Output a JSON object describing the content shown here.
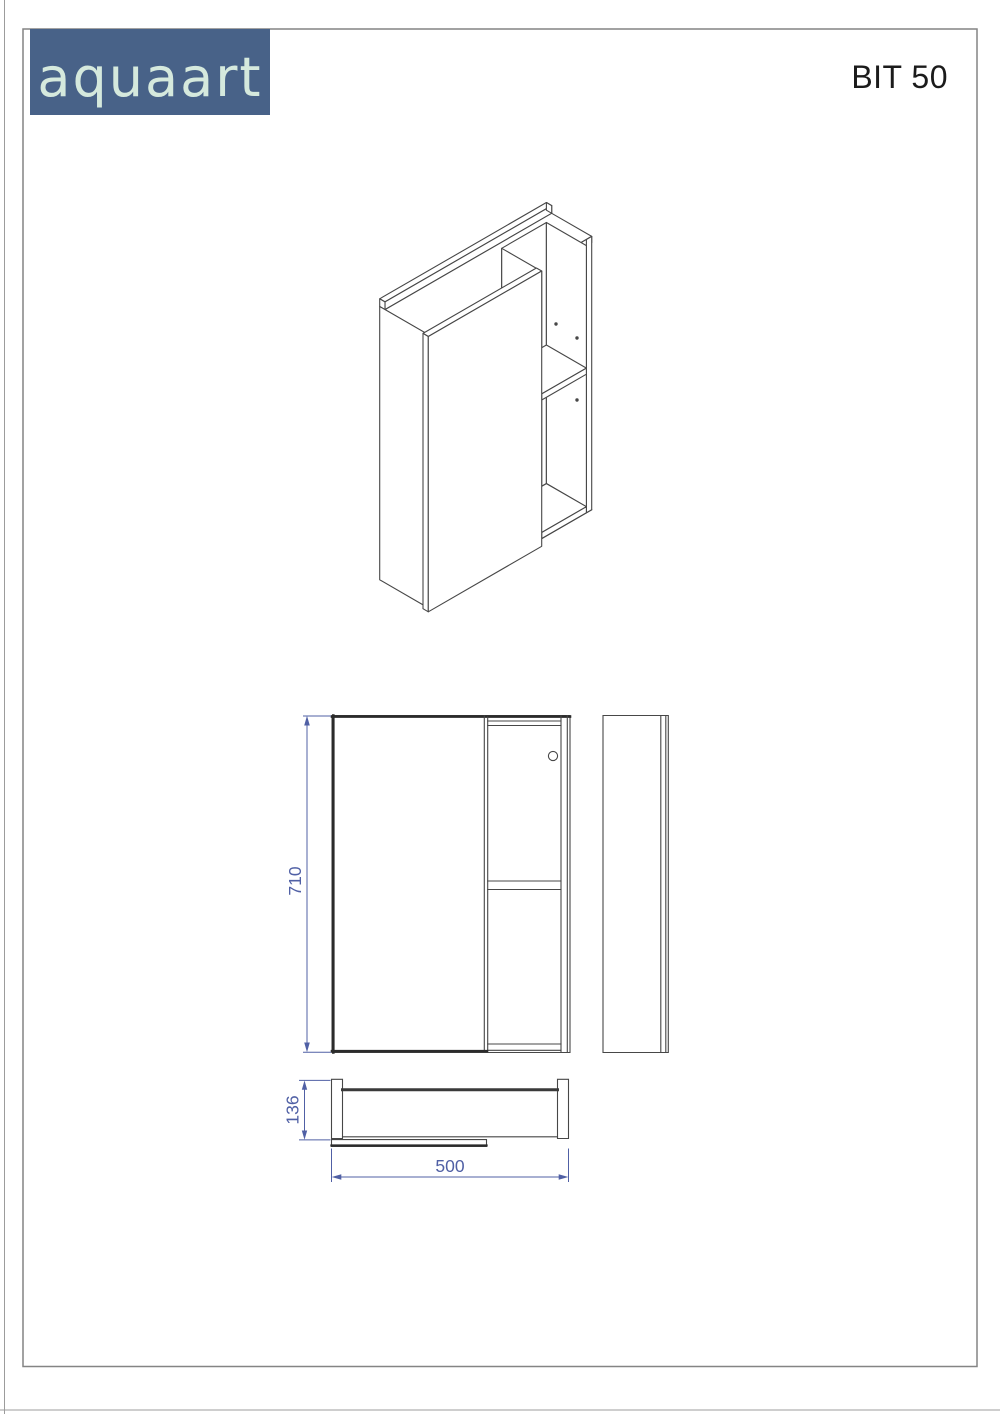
{
  "header": {
    "brand": "aquaart",
    "model": "BIT 50"
  },
  "drawing": {
    "dimensions": {
      "height": "710",
      "depth": "136",
      "width": "500"
    }
  },
  "colors": {
    "logo_bg": "#486288",
    "logo_text": "#d5e9dd",
    "dimension": "#5060a5",
    "line": "#474747"
  }
}
